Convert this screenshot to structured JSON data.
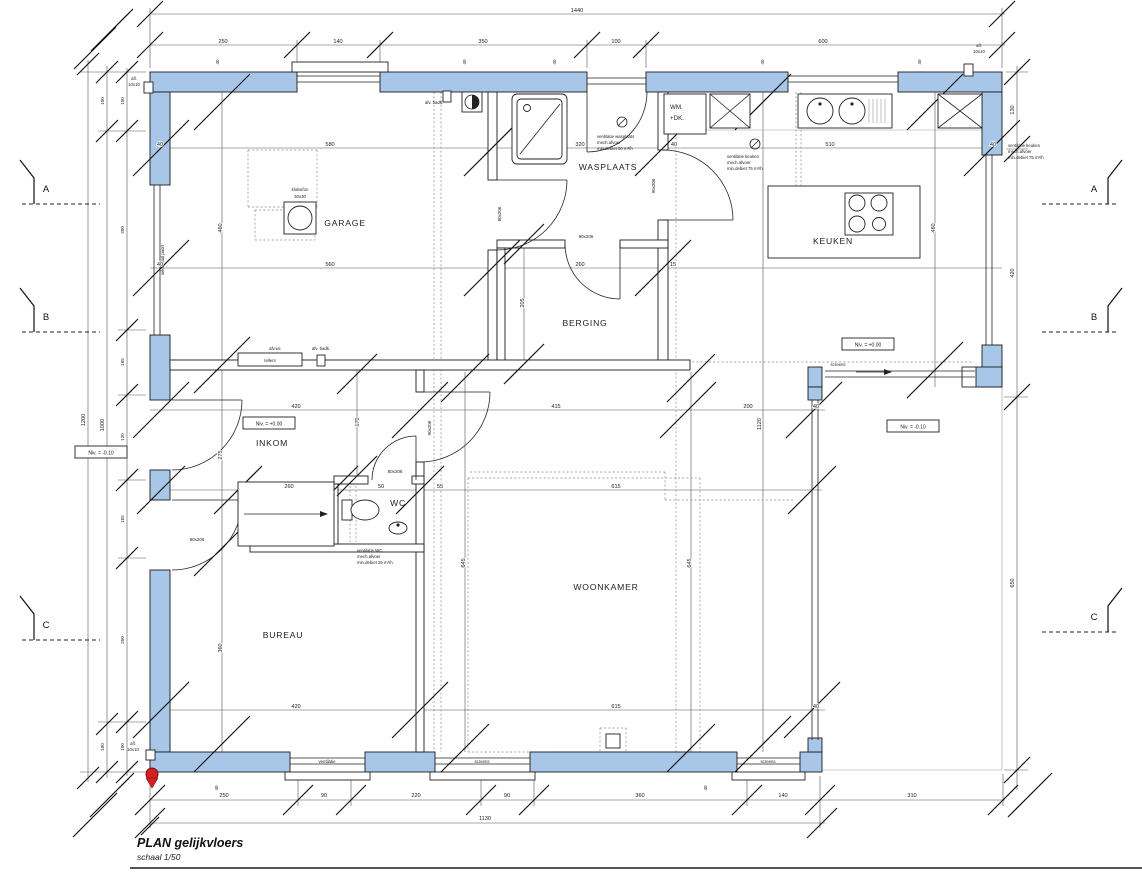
{
  "title": {
    "name": "PLAN gelijkvloers",
    "scale": "schaal 1/50"
  },
  "rooms": {
    "garage": "GARAGE",
    "wasplaats": "WASPLAATS",
    "berging": "BERGING",
    "keuken": "KEUKEN",
    "inkom": "INKOM",
    "wc": "WC",
    "bureau": "BUREAU",
    "woonkamer": "WOONKAMER"
  },
  "levels": {
    "inkom": "Niv. = +0.00",
    "entrance_outside": "Niv. = -0.10",
    "keuken": "Niv. = +0.00",
    "terras": "Niv. = -0.10"
  },
  "sections": {
    "a": "A",
    "b": "B",
    "c": "C"
  },
  "doors": {
    "d80": "80x206",
    "d90": "90x206"
  },
  "annotations": {
    "sektionaal_poort": "sektionaal poort",
    "tellers": "tellers",
    "afv_wc": "afv.wc",
    "afv_badk": "afv. badk.",
    "afl": "afl.",
    "afl_size": "10x10",
    "kloksifon": "kloksifon",
    "kloksifon_size": "30x30",
    "wm_line1": "WM.",
    "wm_line2": "+DK.",
    "ventilatie": "ventilatie",
    "screens": "screens"
  },
  "vents": {
    "wasplaats": [
      "ventilatie wasplaats",
      "mech.afvoer",
      "min.debiet 50 m³/h"
    ],
    "keuken": [
      "ventilatie keuken",
      "mech.afvoer",
      "min.debiet 75 m³/h"
    ],
    "wc": [
      "ventilatie WC",
      "mech.afvoer",
      "min.debiet 25 m³/h"
    ]
  },
  "dims": {
    "wall": "40",
    "top": {
      "total": "1440",
      "segs": [
        "250",
        "140",
        "350",
        "100",
        "600"
      ]
    },
    "bottom": {
      "total": "1130",
      "segs": [
        "250",
        "90",
        "220",
        "90",
        "360",
        "140"
      ],
      "terras": "310"
    },
    "left": {
      "total_outer": "1200",
      "total_inner": "1000",
      "top_100": "100",
      "bottom_100": "100",
      "segs": [
        "100",
        "390",
        "165",
        "120",
        "165",
        "250",
        "100"
      ]
    },
    "right": {
      "segs": [
        "130",
        "420",
        "650"
      ]
    },
    "interior": {
      "garage_w": "580",
      "garage_w2": "560",
      "garage_h": "460",
      "wasplaats_w": "320",
      "berging_w": "260",
      "berging_gap": "15",
      "berging_h": "205",
      "keuken_w": "510",
      "keuken_h": "460",
      "inkom_w": "420",
      "inkom_h": "275",
      "inkom_d": "170",
      "stairs_w": "260",
      "wc_a": "50",
      "wc_b": "55",
      "living_top": "415",
      "living_right": "200",
      "living_w": "615",
      "living_h1": "645",
      "living_h2": "645",
      "bureau_w": "420",
      "bureau_h": "360",
      "total_v": "1120"
    }
  },
  "colors": {
    "wall_fill": "#a8c7e8",
    "paper": "#ffffff",
    "line": "#1a1a1a",
    "marker_red": "#d42020"
  }
}
